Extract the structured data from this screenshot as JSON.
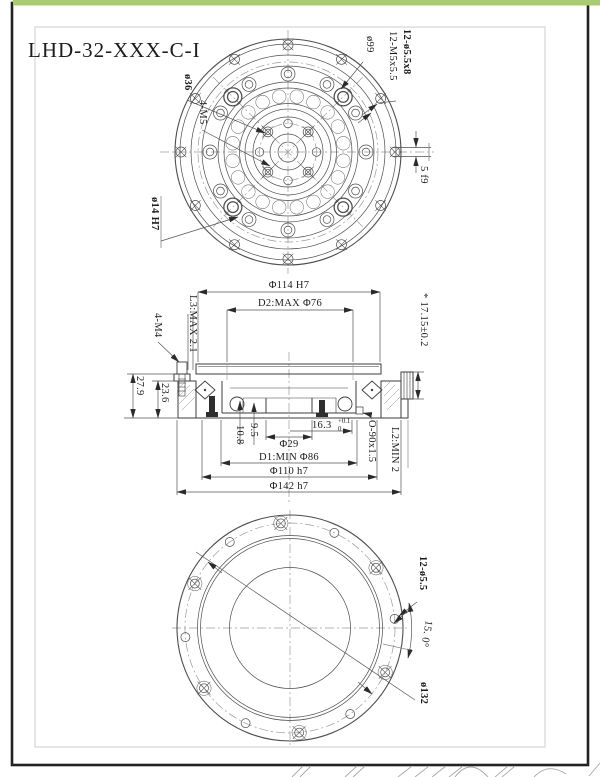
{
  "colors": {
    "accent_green": "#a9cb72",
    "frame_dark": "#232323",
    "line": "#4d4d4d"
  },
  "title_block": {
    "part_number": "LHD-32-XXX-C-I"
  },
  "top_view": {
    "labels": {
      "dia99": "ø99",
      "holes_55": "12-ø5.5x8",
      "holes_m5": "12-M5x5.5",
      "dia36": "ø36",
      "m5_4": "4-M5",
      "dia14": "ø14 H7",
      "key_width": "5 f9"
    }
  },
  "section_view": {
    "labels": {
      "dia114": "Φ114 H7",
      "d2": "D2:MAX Φ76",
      "height": "* 17.15±0.2",
      "l3": "L3:MAX 2.1",
      "m4_4": "4-M4",
      "h236": "23.6",
      "h279": "27.9",
      "d95": "9.5",
      "d108": "10.8",
      "dia29": "Φ29",
      "d163": "16.3",
      "d163_tol_up": "+0.1",
      "d163_tol_dn": "0",
      "d1": "D1:MIN Φ86",
      "dia110": "Φ110 h7",
      "dia142": "Φ142 h7",
      "oring": "O-90x1.5",
      "l2": "L2:MIN 2"
    }
  },
  "bottom_view": {
    "labels": {
      "holes": "12-ø5.5",
      "angle": "15. 0°",
      "dia132": "ø132"
    }
  }
}
